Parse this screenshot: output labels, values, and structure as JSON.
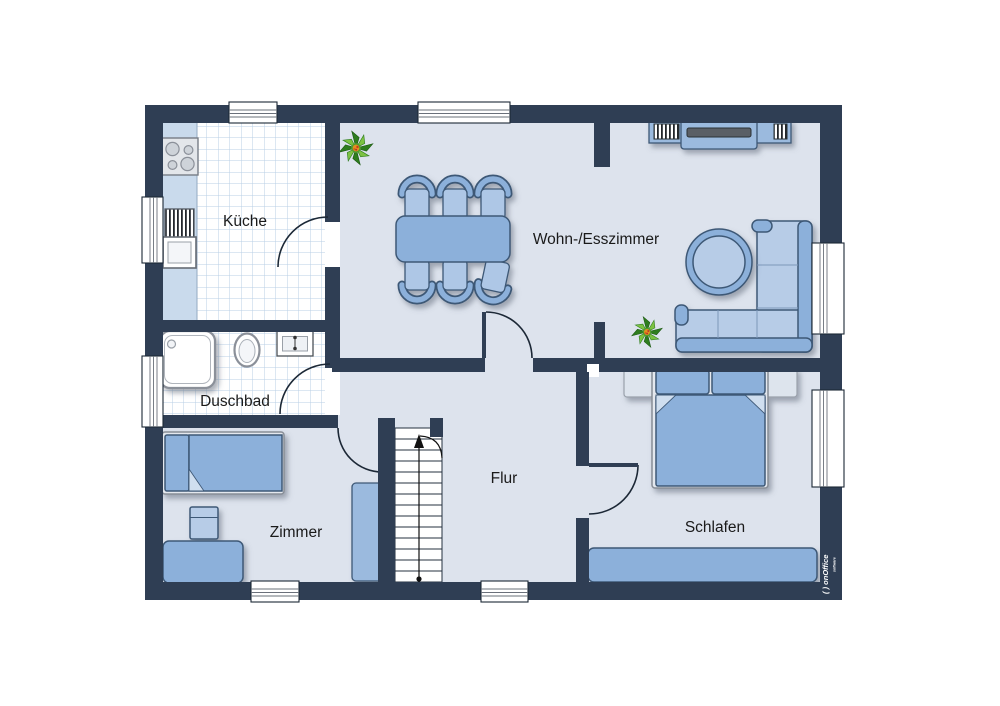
{
  "rooms": {
    "kueche": {
      "label": "Küche"
    },
    "wohn_esszimmer": {
      "label": "Wohn-/Esszimmer"
    },
    "duschbad": {
      "label": "Duschbad"
    },
    "zimmer": {
      "label": "Zimmer"
    },
    "flur": {
      "label": "Flur"
    },
    "schlafen": {
      "label": "Schlafen"
    }
  },
  "branding": {
    "logo_text": "( ) onOffice",
    "logo_subtext": "software"
  },
  "colors": {
    "wall": "#2f3e54",
    "floor": "#dde3ed",
    "tile_line": "#b9cfe6",
    "furn": "#8cb0da",
    "furn_light": "#b7cce7",
    "furn_mid": "#9bbade",
    "furn_border": "#3e5876",
    "counter": "#c9daec",
    "outline": "#1c2836",
    "fixture_border": "#8b9099",
    "label_color": "#1a1a1a",
    "plant_green_dark": "#2e7d1e",
    "plant_green_light": "#7cc242",
    "plant_center": "#e2901e"
  }
}
